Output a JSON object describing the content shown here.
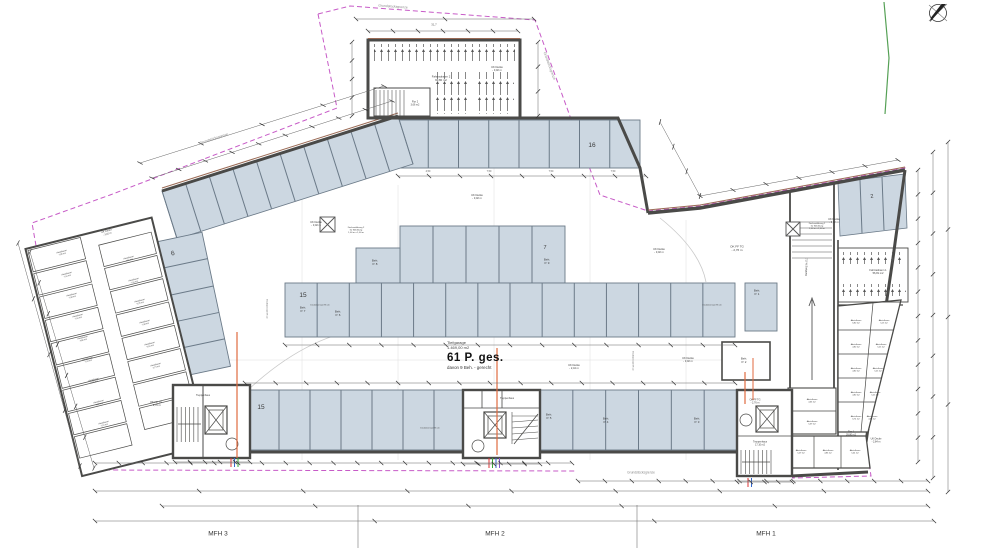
{
  "drawing": {
    "type": "Tiefgarage Grundriss",
    "capacity": {
      "area_name": "Tiefgarage",
      "area_value": "1.469,00 m2",
      "total_spaces": "61 P. ges.",
      "accessible_note": "davon 9 Beh. - gerecht"
    },
    "buildings": {
      "mfh3": "MFH 3",
      "mfh2": "MFH 2",
      "mfh1": "MFH 1"
    },
    "boundary_label": "Grundstücksgrenze",
    "colors": {
      "stall_fill": "#ccd7e1",
      "boundary_magenta": "#c75bc7",
      "wall": "#4a4a48",
      "accent_brown": "#9a6a55",
      "utility_orange": "#e06a3f",
      "green_line": "#55a055"
    }
  },
  "labels": [
    {
      "n": "boundary-label-nw",
      "t": "Grundstücksgrenze",
      "x": 214,
      "y": 139,
      "s": 3.4,
      "r": -18,
      "c": "#8a8a8a"
    },
    {
      "n": "boundary-label-top",
      "t": "Grundstücksgrenze",
      "x": 393,
      "y": 7,
      "s": 3.4,
      "r": 4,
      "c": "#8a8a8a"
    },
    {
      "n": "boundary-label-ne",
      "t": "Grundstücksgrenze",
      "x": 549,
      "y": 66,
      "s": 3.4,
      "r": 70,
      "c": "#8a8a8a"
    },
    {
      "n": "boundary-label-s",
      "t": "Grundstücksgrenze",
      "x": 641,
      "y": 473,
      "s": 3.2,
      "r": 0,
      "c": "#8a8a8a"
    },
    {
      "n": "room-fahrradraum-2",
      "t": "Fahrradraum 2\n90,80 m2",
      "x": 441,
      "y": 79,
      "s": 2.8,
      "r": 0
    },
    {
      "n": "room-fahrradraum-1",
      "t": "Fahrradraum 1\n56,81 m2",
      "x": 878,
      "y": 272,
      "s": 2.6,
      "r": 0
    },
    {
      "n": "room-flur-2",
      "t": "Flur 2\n3,66 m2",
      "x": 415,
      "y": 104,
      "s": 2.4,
      "r": 0
    },
    {
      "n": "room-flur-1",
      "t": "Flur 1\n39,80 m2",
      "x": 851,
      "y": 434,
      "s": 2.4,
      "r": 0
    },
    {
      "n": "room-treppenhaus-mfh3",
      "t": "Treppenhaus",
      "x": 203,
      "y": 396,
      "s": 2.4,
      "r": 0
    },
    {
      "n": "room-treppenhaus-mfh2",
      "t": "Treppenhaus",
      "x": 507,
      "y": 399,
      "s": 2.4,
      "r": 0
    },
    {
      "n": "room-treppenhaus-mfh1",
      "t": "Treppenhaus\n17,10 m2",
      "x": 760,
      "y": 444,
      "s": 2.4,
      "r": 0
    },
    {
      "n": "level-uk-decke-1",
      "t": "UK Decke\n- 3,02 m",
      "x": 497,
      "y": 69,
      "s": 2.6,
      "r": 0
    },
    {
      "n": "level-uk-decke-2",
      "t": "UK Decke\n- 3,02 m",
      "x": 316,
      "y": 224,
      "s": 2.6,
      "r": 0
    },
    {
      "n": "level-uk-decke-3",
      "t": "UK Decke\n- 3,02 m",
      "x": 477,
      "y": 197,
      "s": 2.6,
      "r": 0
    },
    {
      "n": "level-uk-decke-4",
      "t": "UK Decke\n- 3,02 m",
      "x": 659,
      "y": 251,
      "s": 2.6,
      "r": 0
    },
    {
      "n": "level-uk-decke-5",
      "t": "UK Decke\n- 3,02 m",
      "x": 688,
      "y": 360,
      "s": 2.6,
      "r": 0
    },
    {
      "n": "level-uk-decke-6",
      "t": "UK Decke\n- 3,02 m",
      "x": 834,
      "y": 221,
      "s": 2.6,
      "r": 0
    },
    {
      "n": "level-uk-decke-7",
      "t": "UK Decke\n- 3,02 m",
      "x": 107,
      "y": 233,
      "s": 2.4,
      "r": -15
    },
    {
      "n": "level-uk-decke-244",
      "t": "UK Decke\n- 2,44 m",
      "x": 574,
      "y": 367,
      "s": 2.6,
      "r": 0
    },
    {
      "n": "level-uk-decke-284",
      "t": "UK Decke\n- 2,84 m",
      "x": 876,
      "y": 441,
      "s": 2.4,
      "r": 0
    },
    {
      "n": "level-ok-ff-tg-1",
      "t": "OK FF TG\n- 2,76 m",
      "x": 737,
      "y": 249,
      "s": 3,
      "r": 0
    },
    {
      "n": "level-ok-ff-tg-2",
      "t": "OK FF TG\n- 2,76 m",
      "x": 156,
      "y": 404,
      "s": 2.6,
      "r": 0
    },
    {
      "n": "level-ok-ff-tg-3",
      "t": "OK FF TG\n- 2,76 m",
      "x": 755,
      "y": 402,
      "s": 2.4,
      "r": 0
    },
    {
      "n": "ramp-slope-label",
      "t": "7,5 % Steigung",
      "x": 806,
      "y": 267,
      "s": 2.6,
      "r": 90
    },
    {
      "n": "stall-count-6",
      "t": "6",
      "x": 173,
      "y": 254,
      "s": 6.5,
      "r": -14
    },
    {
      "n": "stall-count-16",
      "t": "16",
      "x": 592,
      "y": 146,
      "s": 6.5,
      "r": 0
    },
    {
      "n": "stall-count-15a",
      "t": "15",
      "x": 303,
      "y": 296,
      "s": 6.5,
      "r": 0
    },
    {
      "n": "stall-count-15b",
      "t": "15",
      "x": 261,
      "y": 408,
      "s": 6.5,
      "r": 0
    },
    {
      "n": "stall-count-7",
      "t": "7",
      "x": 545,
      "y": 248,
      "s": 5.5,
      "r": 0
    },
    {
      "n": "stall-count-2",
      "t": "2",
      "x": 872,
      "y": 197,
      "s": 5.5,
      "r": -8
    },
    {
      "n": "stall-beh-p9",
      "t": "Beh.\nP. 9",
      "x": 547,
      "y": 262,
      "s": 3,
      "r": 0
    },
    {
      "n": "stall-beh-p8",
      "t": "Beh.\nP. 8",
      "x": 375,
      "y": 263,
      "s": 3,
      "r": 0
    },
    {
      "n": "stall-beh-p7",
      "t": "Beh.\nP. 7",
      "x": 303,
      "y": 310,
      "s": 3,
      "r": 0
    },
    {
      "n": "stall-beh-p6",
      "t": "Beh.\nP. 6",
      "x": 338,
      "y": 314,
      "s": 3,
      "r": 0
    },
    {
      "n": "stall-beh-p5",
      "t": "Beh.\nP. 5",
      "x": 549,
      "y": 417,
      "s": 3,
      "r": 0
    },
    {
      "n": "stall-beh-p4",
      "t": "Beh.\nP. 4",
      "x": 606,
      "y": 421,
      "s": 3,
      "r": 0
    },
    {
      "n": "stall-beh-p3",
      "t": "Beh.\nP. 3",
      "x": 697,
      "y": 421,
      "s": 3,
      "r": 0
    },
    {
      "n": "stall-beh-p2",
      "t": "Beh.\nP. 2",
      "x": 744,
      "y": 361,
      "s": 3,
      "r": 0
    },
    {
      "n": "stall-beh-p1",
      "t": "Beh.\nP. 1",
      "x": 757,
      "y": 293,
      "s": 3,
      "r": 0
    },
    {
      "n": "ceiling-opening-2-label",
      "t": "Deckenöffnung 2\nfür Belüftung\n1,00 m x 1,00 m",
      "x": 356,
      "y": 230,
      "s": 2.2,
      "r": 0
    },
    {
      "n": "ceiling-opening-1-label",
      "t": "Deckenöffnung 1\nfür Belüftung\n1,00 m x 1,00 m",
      "x": 817,
      "y": 226,
      "s": 2.2,
      "r": 0
    },
    {
      "n": "ceiling-offset-1",
      "t": "Deckenversatz 96 cm",
      "x": 320,
      "y": 305,
      "s": 2,
      "r": 0
    },
    {
      "n": "ceiling-offset-2",
      "t": "Deckenversatz 96 cm",
      "x": 712,
      "y": 305,
      "s": 2,
      "r": 0
    },
    {
      "n": "ceiling-offset-3",
      "t": "Deckenversatz 96 cm",
      "x": 430,
      "y": 428,
      "s": 2,
      "r": 0
    },
    {
      "n": "ceiling-offset-4",
      "t": "Deckenversatz 96 cm",
      "x": 267,
      "y": 309,
      "s": 2,
      "r": 90
    },
    {
      "n": "ceiling-offset-5",
      "t": "Deckenversatz 96 cm",
      "x": 633,
      "y": 361,
      "s": 2,
      "r": 90
    },
    {
      "n": "dim-31-7",
      "t": "31,7",
      "x": 434,
      "y": 25,
      "s": 2.8,
      "r": 0,
      "c": "#555"
    },
    {
      "n": "dim-bay-1",
      "t": "4,50",
      "x": 428,
      "y": 172,
      "s": 2.4,
      "r": 0,
      "c": "#555"
    },
    {
      "n": "dim-bay-2",
      "t": "7,50",
      "x": 489,
      "y": 172,
      "s": 2.4,
      "r": 0,
      "c": "#555"
    },
    {
      "n": "dim-bay-3",
      "t": "7,50",
      "x": 551,
      "y": 172,
      "s": 2.4,
      "r": 0,
      "c": "#555"
    },
    {
      "n": "dim-bay-4",
      "t": "7,50",
      "x": 613,
      "y": 172,
      "s": 2.4,
      "r": 0,
      "c": "#555"
    },
    {
      "n": "room-abstellraum",
      "t": "Abstellraum\n7,95 m2",
      "x": 62,
      "y": 253,
      "s": 2,
      "r": -14
    },
    {
      "n": "room-abstellraum",
      "t": "Abstellraum\n7,44 m2",
      "x": 67,
      "y": 275,
      "s": 2,
      "r": -14
    },
    {
      "n": "room-abstellraum",
      "t": "Abstellraum\n7,48 m2",
      "x": 72,
      "y": 296,
      "s": 2,
      "r": -14
    },
    {
      "n": "room-abstellraum",
      "t": "Abstellraum\n7,44 m2",
      "x": 78,
      "y": 317,
      "s": 2,
      "r": -14
    },
    {
      "n": "room-abstellraum",
      "t": "Abstellraum\n4,80 m2",
      "x": 83,
      "y": 339,
      "s": 2,
      "r": -14
    },
    {
      "n": "room-abstellraum",
      "t": "Abstellraum\n7,43 m2",
      "x": 88,
      "y": 360,
      "s": 2,
      "r": -14
    },
    {
      "n": "room-abstellraum",
      "t": "Abstellraum\n5,66 m2",
      "x": 94,
      "y": 381,
      "s": 2,
      "r": -14
    },
    {
      "n": "room-abstellraum",
      "t": "Abstellraum\n4,86 m2",
      "x": 99,
      "y": 403,
      "s": 2,
      "r": -14
    },
    {
      "n": "room-abstellraum",
      "t": "Abstellraum\n7,16 m2",
      "x": 104,
      "y": 424,
      "s": 2,
      "r": -14
    },
    {
      "n": "room-abstellraum",
      "t": "Abstellraum\n4,66 m2",
      "x": 129,
      "y": 259,
      "s": 2,
      "r": -14
    },
    {
      "n": "room-abstellraum",
      "t": "Abstellraum\n7,44 m2",
      "x": 134,
      "y": 281,
      "s": 2,
      "r": -14
    },
    {
      "n": "room-abstellraum",
      "t": "Abstellraum\n5,25 m2",
      "x": 140,
      "y": 302,
      "s": 2,
      "r": -14
    },
    {
      "n": "room-abstellraum",
      "t": "Abstellraum\n7,48 m2",
      "x": 145,
      "y": 323,
      "s": 2,
      "r": -14
    },
    {
      "n": "room-abstellraum",
      "t": "Abstellraum\n5,04 m2",
      "x": 150,
      "y": 345,
      "s": 2,
      "r": -14
    },
    {
      "n": "room-abstellraum",
      "t": "Abstellraum\n3,73 m2",
      "x": 156,
      "y": 366,
      "s": 2,
      "r": -14
    },
    {
      "n": "room-abstellraum",
      "t": "Abstellraum\n6,80 m2",
      "x": 856,
      "y": 322,
      "s": 2,
      "r": 0
    },
    {
      "n": "room-abstellraum",
      "t": "Abstellraum\n4,80 m2",
      "x": 856,
      "y": 346,
      "s": 2,
      "r": 0
    },
    {
      "n": "room-abstellraum",
      "t": "Abstellraum\n4,80 m2",
      "x": 856,
      "y": 370,
      "s": 2,
      "r": 0
    },
    {
      "n": "room-abstellraum",
      "t": "Abstellraum\n4,80 m2",
      "x": 856,
      "y": 394,
      "s": 2,
      "r": 0
    },
    {
      "n": "room-abstellraum",
      "t": "Abstellraum\n6,74 m2",
      "x": 856,
      "y": 418,
      "s": 2,
      "r": 0
    },
    {
      "n": "room-abstellraum",
      "t": "Abstellraum\n5,13 m2",
      "x": 884,
      "y": 322,
      "s": 2,
      "r": 0
    },
    {
      "n": "room-abstellraum",
      "t": "Abstellraum\n5,25 m2",
      "x": 881,
      "y": 346,
      "s": 2,
      "r": 0
    },
    {
      "n": "room-abstellraum",
      "t": "Abstellraum\n5,25 m2",
      "x": 878,
      "y": 370,
      "s": 2,
      "r": 0
    },
    {
      "n": "room-abstellraum",
      "t": "Abstellraum\n5,25 m2",
      "x": 875,
      "y": 394,
      "s": 2,
      "r": 0
    },
    {
      "n": "room-abstellraum",
      "t": "Abstellraum\n4,96 m2",
      "x": 872,
      "y": 418,
      "s": 2,
      "r": 0
    },
    {
      "n": "room-abstellraum",
      "t": "Abstellraum\n5,29 m2",
      "x": 801,
      "y": 452,
      "s": 2,
      "r": 0
    },
    {
      "n": "room-abstellraum",
      "t": "Abstellraum\n4,86 m2",
      "x": 828,
      "y": 452,
      "s": 2,
      "r": 0
    },
    {
      "n": "room-abstellraum",
      "t": "Abstellraum\n5,04 m2",
      "x": 855,
      "y": 452,
      "s": 2,
      "r": 0
    },
    {
      "n": "room-abstellraum",
      "t": "Abstellraum\n4,66 m2",
      "x": 812,
      "y": 401,
      "s": 2,
      "r": 0
    },
    {
      "n": "room-abstellraum",
      "t": "Abstellraum\n5,39 m2",
      "x": 812,
      "y": 423,
      "s": 2,
      "r": 0
    }
  ]
}
